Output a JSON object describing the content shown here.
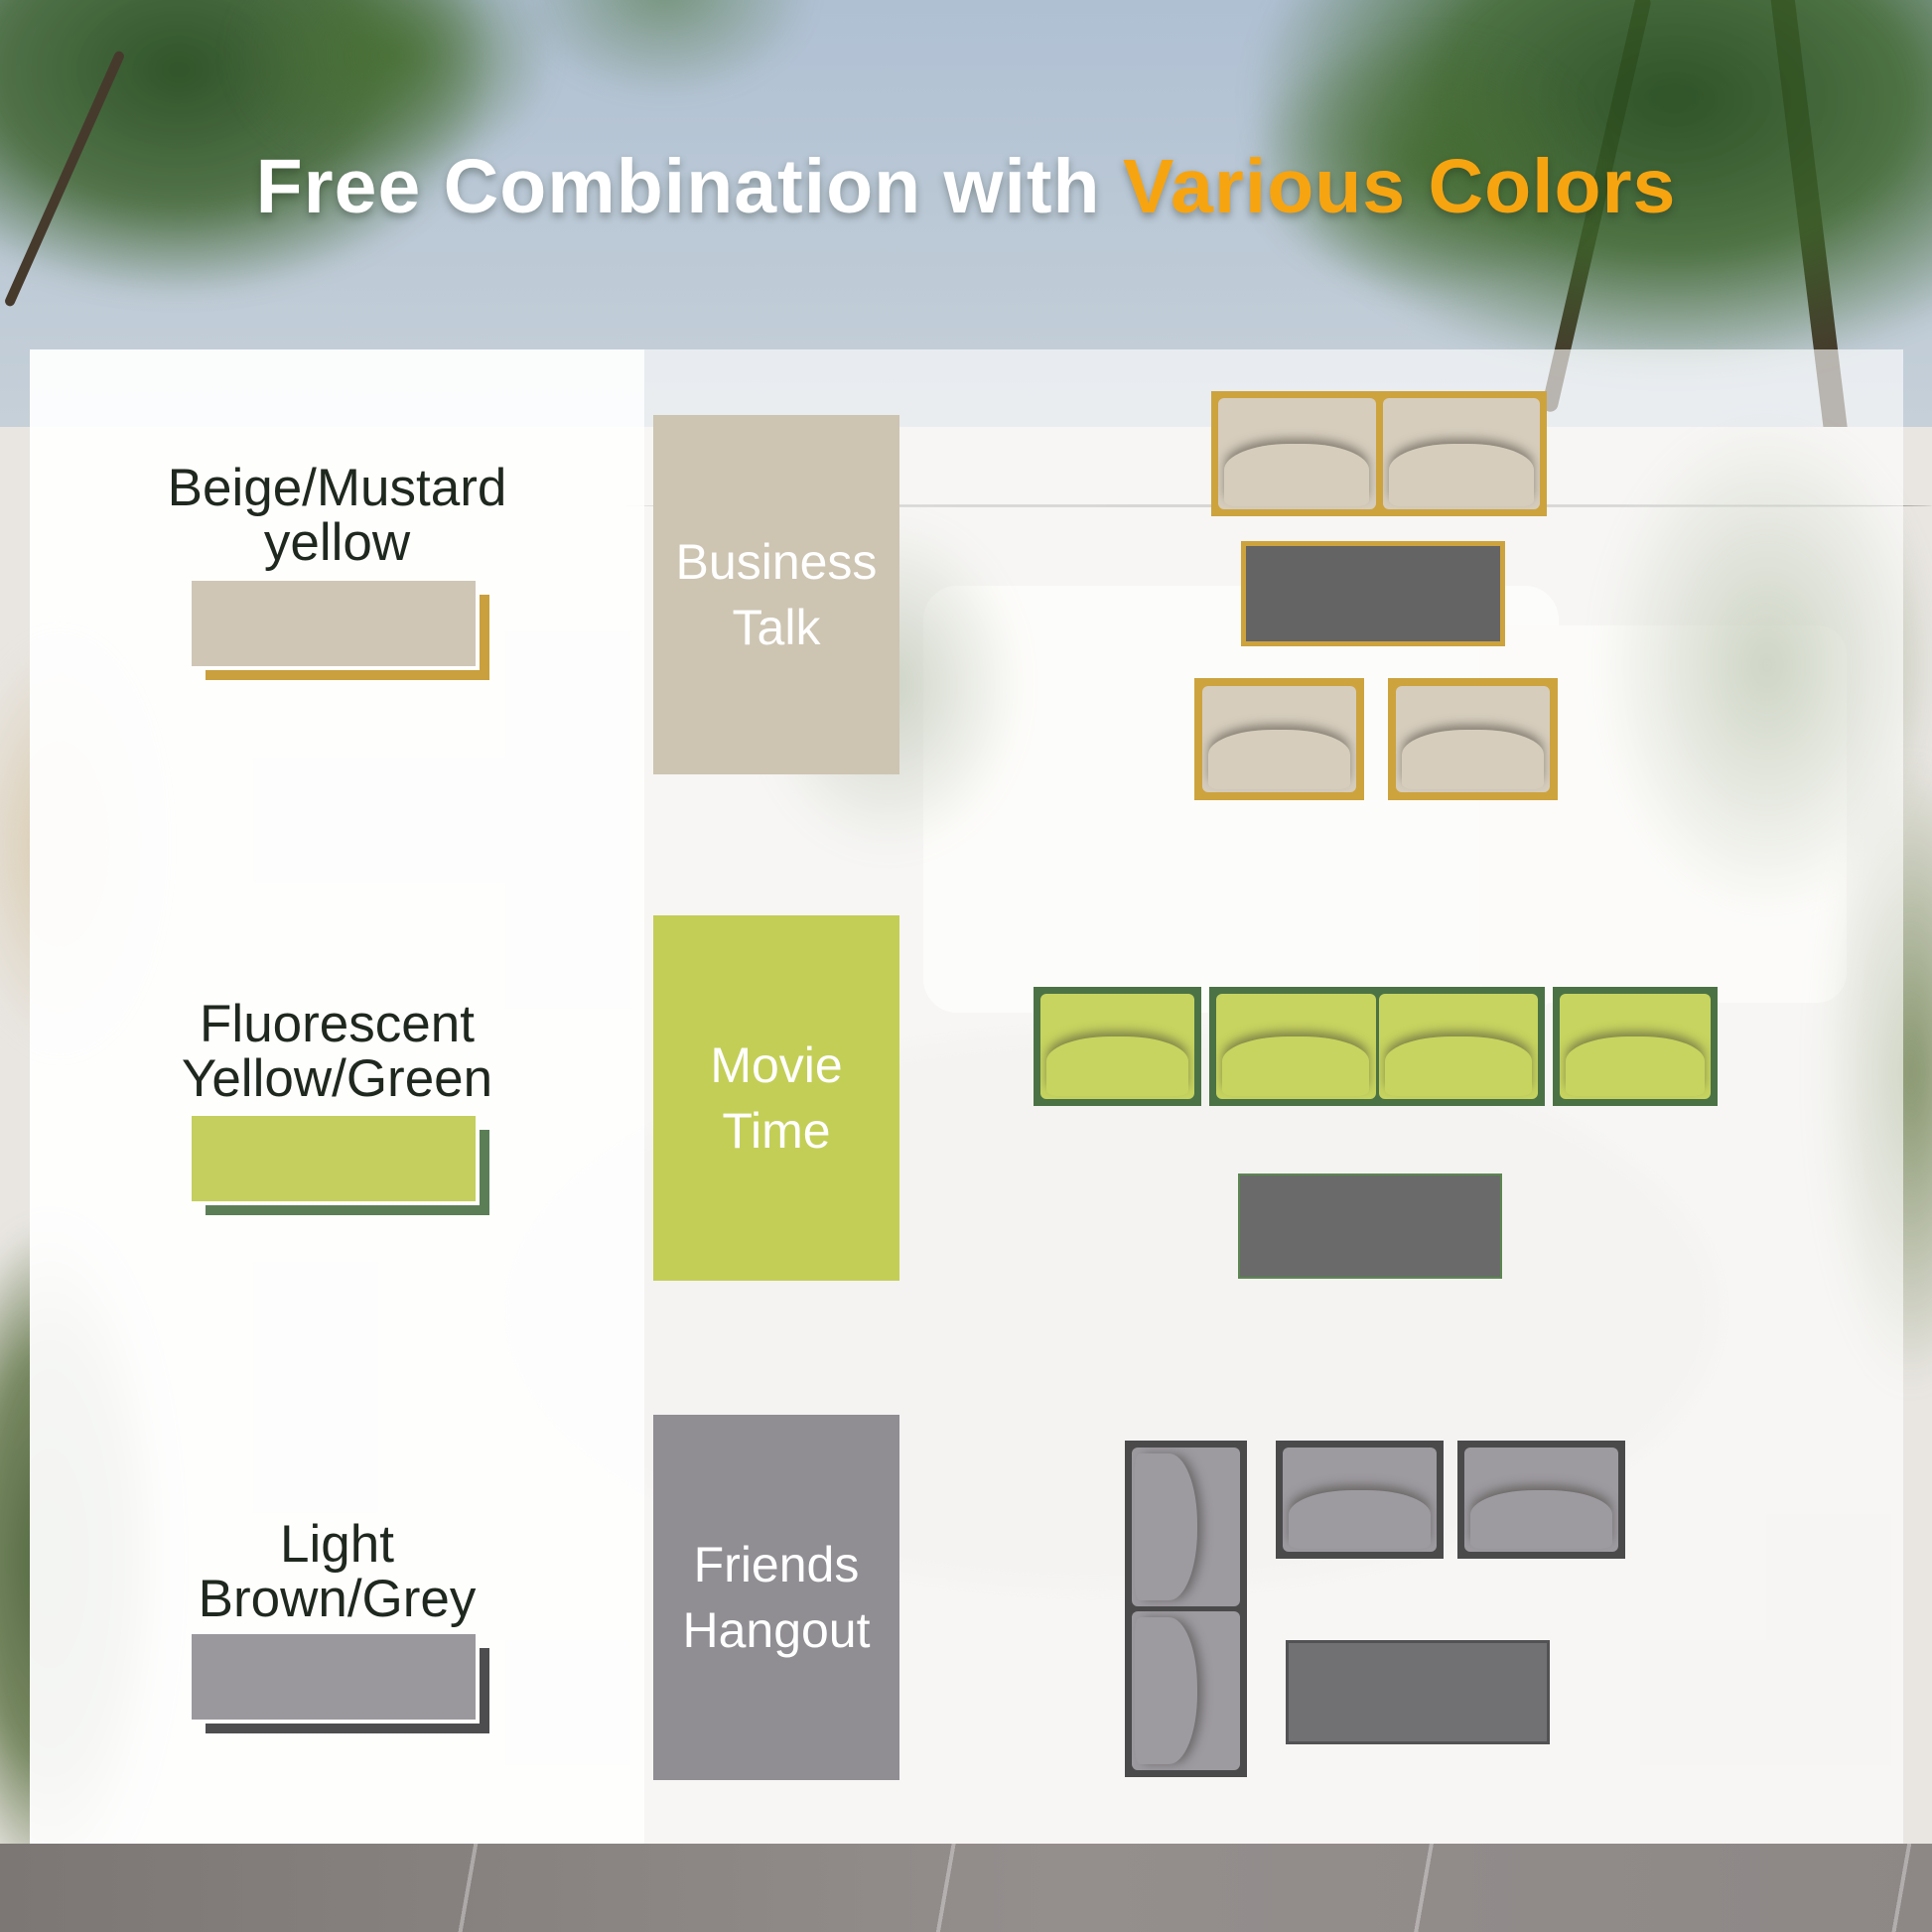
{
  "title": {
    "text_white": "Free Combination with",
    "text_orange": "Various Colors",
    "orange_color": "#f7a411"
  },
  "color_options": [
    {
      "label_line1": "Beige/Mustard",
      "label_line2": "yellow",
      "swatch_fill": "#cfc6b6",
      "swatch_shadow": "#c9a03d"
    },
    {
      "label_line1": "Fluorescent",
      "label_line2": "Yellow/Green",
      "swatch_fill": "#c4cf5d",
      "swatch_shadow": "#5c7e57"
    },
    {
      "label_line1": "Light",
      "label_line2": "Brown/Grey",
      "swatch_fill": "#9b989d",
      "swatch_shadow": "#4d4d4f"
    }
  ],
  "scenes": [
    {
      "label_line1": "Business",
      "label_line2": "Talk",
      "block_color": "#cdc4b2",
      "cushion_fill": "#d6cdbd",
      "outline_color": "#cda33e",
      "table_color": "#646464"
    },
    {
      "label_line1": "Movie",
      "label_line2": "Time",
      "block_color": "#c3ce56",
      "cushion_fill": "#c7d45f",
      "outline_color": "#4b7245",
      "table_color": "#6a6a6a"
    },
    {
      "label_line1": "Friends",
      "label_line2": "Hangout",
      "block_color": "#908d93",
      "cushion_fill": "#9d9aa0",
      "outline_color": "#4a4a4b",
      "table_color": "#717173"
    }
  ]
}
